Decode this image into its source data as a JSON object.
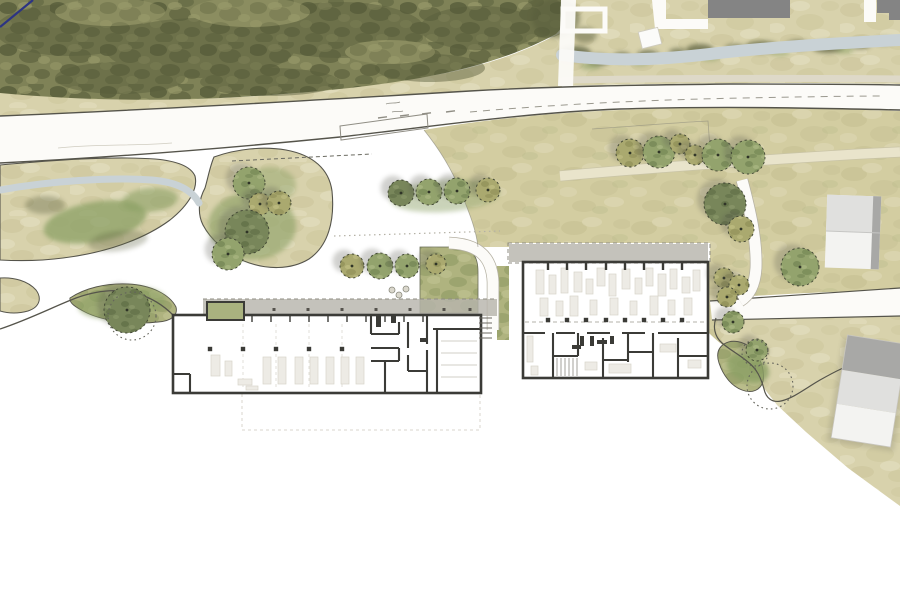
{
  "scene": {
    "width": 900,
    "height": 600,
    "type": "architectural-site-plan"
  },
  "palette": {
    "paper": "#ffffff",
    "forest": "#7f8257",
    "forest_dark": "#585d3b",
    "forest_lite": "#9b9c6c",
    "ground": "#d8d2ac",
    "ground_dark": "#c9c297",
    "ground_lite": "#e5dfc2",
    "lawn": "#d3cda1",
    "lawn_dark": "#c3bd90",
    "lawn_lite": "#e0dab8",
    "lawn_green": "#b7b98a",
    "green": "#afb37f",
    "green_deep": "#8a9660",
    "green_lite": "#c6c797",
    "scrub": "#565b3a",
    "bush": "#8ba065",
    "stream": "#c9d2d6",
    "road_fill": "#fcfbf8",
    "road_line": "#55544b",
    "soft_line": "#b7b3a5",
    "wall": "#3b3b37",
    "furn": "#edebe5",
    "furn_edge": "#d7d4ca",
    "canopy": "#b7b4ac",
    "roof": "#848484",
    "house_lite": "#f3f3f1",
    "house_mid": "#e0e0de",
    "house_side": "#a8a8a6",
    "blue": "#2c3483",
    "shadow": "#57574d",
    "tree_g": "#93a36d",
    "tree_o": "#aaa96f",
    "tree_d": "#78865a",
    "tree_edge": "#3f4433",
    "dot": "#2f3427"
  },
  "trees": {
    "planted": [
      [
        630,
        153,
        14,
        "o"
      ],
      [
        659,
        152,
        16,
        "g"
      ],
      [
        680,
        144,
        10,
        "o"
      ],
      [
        695,
        155,
        10,
        "o"
      ],
      [
        718,
        155,
        16,
        "g"
      ],
      [
        748,
        157,
        17,
        "g"
      ],
      [
        725,
        204,
        21,
        "d"
      ],
      [
        741,
        229,
        13,
        "o"
      ],
      [
        800,
        267,
        19,
        "g"
      ],
      [
        724,
        278,
        10,
        "o"
      ],
      [
        739,
        285,
        10,
        "o"
      ],
      [
        727,
        297,
        10,
        "o"
      ],
      [
        733,
        322,
        11,
        "g"
      ],
      [
        757,
        350,
        11,
        "g"
      ],
      [
        249,
        183,
        16,
        "g"
      ],
      [
        260,
        204,
        11,
        "o"
      ],
      [
        279,
        203,
        12,
        "o"
      ],
      [
        247,
        232,
        22,
        "d"
      ],
      [
        228,
        254,
        16,
        "g"
      ],
      [
        401,
        193,
        13,
        "d"
      ],
      [
        429,
        192,
        13,
        "g"
      ],
      [
        457,
        191,
        13,
        "g"
      ],
      [
        488,
        190,
        12,
        "o"
      ],
      [
        352,
        266,
        12,
        "o"
      ],
      [
        380,
        266,
        13,
        "g"
      ],
      [
        407,
        266,
        12,
        "g"
      ],
      [
        436,
        264,
        10,
        "o"
      ],
      [
        127,
        310,
        23,
        "d"
      ]
    ],
    "dotted": [
      [
        770,
        386,
        23
      ],
      [
        755,
        353,
        13
      ],
      [
        132,
        316,
        24
      ]
    ]
  },
  "vegetation": [
    [
      575,
      53,
      16,
      7,
      0,
      "d",
      0.75
    ],
    [
      598,
      60,
      12,
      6,
      0,
      "d",
      0.7
    ],
    [
      622,
      57,
      9,
      5,
      0,
      "d",
      0.65
    ],
    [
      648,
      55,
      11,
      5,
      0,
      "d",
      0.7
    ],
    [
      678,
      52,
      9,
      4,
      0,
      "d",
      0.6
    ],
    [
      700,
      50,
      14,
      6,
      0,
      "d",
      0.7
    ],
    [
      735,
      48,
      10,
      4,
      0,
      "d",
      0.6
    ],
    [
      762,
      47,
      17,
      6,
      0,
      "d",
      0.72
    ],
    [
      798,
      45,
      12,
      5,
      0,
      "d",
      0.65
    ],
    [
      828,
      47,
      16,
      6,
      0,
      "d",
      0.72
    ],
    [
      860,
      44,
      11,
      5,
      0,
      "d",
      0.65
    ],
    [
      884,
      41,
      9,
      4,
      0,
      "d",
      0.6
    ],
    [
      590,
      66,
      10,
      4,
      0,
      "g",
      0.55
    ],
    [
      640,
      62,
      9,
      4,
      0,
      "g",
      0.5
    ],
    [
      710,
      57,
      10,
      4,
      0,
      "g",
      0.55
    ],
    [
      780,
      52,
      10,
      4,
      0,
      "g",
      0.5
    ],
    [
      845,
      50,
      9,
      4,
      0,
      "g",
      0.5
    ],
    [
      556,
      18,
      24,
      20,
      0,
      "d",
      0.5
    ],
    [
      585,
      35,
      12,
      8,
      0,
      "d",
      0.45
    ],
    [
      95,
      222,
      52,
      20,
      -10,
      "g",
      0.75
    ],
    [
      150,
      200,
      28,
      12,
      -5,
      "g",
      0.6
    ],
    [
      45,
      205,
      20,
      9,
      0,
      "d",
      0.35
    ],
    [
      118,
      241,
      30,
      10,
      -8,
      "d",
      0.3
    ],
    [
      252,
      226,
      44,
      34,
      0,
      "g",
      0.6
    ],
    [
      270,
      185,
      26,
      18,
      0,
      "g",
      0.45
    ],
    [
      122,
      303,
      44,
      16,
      -5,
      "g",
      0.6
    ],
    [
      748,
      368,
      22,
      14,
      20,
      "g",
      0.8
    ],
    [
      760,
      351,
      9,
      5,
      0,
      "d",
      0.4
    ],
    [
      445,
      196,
      55,
      16,
      -4,
      "g",
      0.45
    ]
  ],
  "buildings": {
    "left": {
      "outline": [
        173,
        315,
        308,
        78
      ],
      "walls": [
        [
          427,
          316,
          427,
          344
        ],
        [
          427,
          350,
          427,
          392
        ],
        [
          433,
          329,
          481,
          329
        ],
        [
          437,
          329,
          437,
          392
        ],
        [
          371,
          316,
          371,
          334
        ],
        [
          371,
          334,
          399,
          334
        ],
        [
          399,
          322,
          399,
          334
        ],
        [
          371,
          348,
          399,
          348
        ],
        [
          399,
          348,
          399,
          361
        ],
        [
          371,
          361,
          399,
          361
        ],
        [
          385,
          361,
          385,
          392
        ],
        [
          408,
          322,
          408,
          348
        ],
        [
          408,
          355,
          408,
          371
        ],
        [
          408,
          371,
          426,
          371
        ],
        [
          173,
          374,
          190,
          374
        ],
        [
          190,
          374,
          190,
          392
        ]
      ],
      "stubs": [
        [
          376,
          316,
          5,
          11
        ],
        [
          391,
          316,
          5,
          7
        ],
        [
          420,
          338,
          7,
          4
        ]
      ],
      "columns": {
        "y": 349,
        "xs": [
          210,
          243,
          276,
          309,
          342
        ]
      },
      "facade_ticks": {
        "y": 316,
        "h": 6,
        "xs": [
          252,
          271,
          290,
          309,
          328,
          347,
          366,
          385,
          404,
          423
        ]
      },
      "grid_lines": {
        "y1": 324,
        "y2": 390,
        "xs": [
          243,
          276,
          309,
          342
        ]
      },
      "vehicles": [
        [
          263,
          357,
          8,
          27
        ],
        [
          278,
          357,
          8,
          27
        ],
        [
          295,
          357,
          8,
          27
        ],
        [
          310,
          357,
          8,
          27
        ],
        [
          326,
          357,
          8,
          27
        ],
        [
          341,
          357,
          8,
          27
        ],
        [
          356,
          357,
          8,
          27
        ],
        [
          211,
          355,
          9,
          21
        ],
        [
          225,
          361,
          7,
          15
        ],
        [
          238,
          379,
          14,
          6
        ],
        [
          246,
          386,
          12,
          4
        ]
      ],
      "room_lines": {
        "x1": 441,
        "x2": 477,
        "ys": [
          341,
          353,
          365,
          377
        ]
      },
      "basement": [
        242,
        393,
        238,
        37
      ],
      "canopy": [
        203,
        299,
        294,
        17
      ],
      "canopy_ticks": {
        "y": 308,
        "xs": [
          240,
          274,
          308,
          342,
          376,
          410,
          444,
          470
        ]
      },
      "planter": [
        207,
        302,
        37,
        18
      ]
    },
    "right": {
      "outline": [
        523,
        262,
        185,
        116
      ],
      "walls": [
        [
          523,
          333,
          545,
          333
        ],
        [
          556,
          333,
          575,
          333
        ],
        [
          587,
          333,
          610,
          333
        ],
        [
          622,
          333,
          645,
          333
        ],
        [
          658,
          333,
          708,
          333
        ],
        [
          553,
          333,
          553,
          377
        ],
        [
          578,
          333,
          578,
          356
        ],
        [
          603,
          338,
          603,
          377
        ],
        [
          628,
          333,
          628,
          362
        ],
        [
          653,
          333,
          653,
          377
        ],
        [
          678,
          338,
          678,
          377
        ],
        [
          553,
          356,
          578,
          356
        ],
        [
          603,
          360,
          628,
          360
        ],
        [
          628,
          352,
          653,
          352
        ],
        [
          678,
          356,
          708,
          356
        ]
      ],
      "stubs": [
        [
          580,
          336,
          4,
          10
        ],
        [
          590,
          336,
          4,
          10
        ],
        [
          597,
          340,
          10,
          4
        ],
        [
          572,
          345,
          9,
          4
        ],
        [
          610,
          336,
          4,
          8
        ]
      ],
      "top_bars": {
        "y": 263,
        "h": 7,
        "xs": [
          548,
          567,
          586,
          606,
          625,
          644,
          663,
          682
        ]
      },
      "mid_columns": {
        "y": 320,
        "xs": [
          548,
          567,
          586,
          606,
          625,
          644,
          663,
          682
        ]
      },
      "mid_dash": {
        "y": 322,
        "x1": 525,
        "x2": 706
      },
      "equipment": [
        [
          536,
          270,
          8,
          24
        ],
        [
          549,
          275,
          7,
          19
        ],
        [
          561,
          268,
          7,
          25
        ],
        [
          574,
          272,
          8,
          20
        ],
        [
          586,
          279,
          7,
          15
        ],
        [
          597,
          268,
          8,
          18
        ],
        [
          609,
          274,
          7,
          22
        ],
        [
          622,
          269,
          8,
          20
        ],
        [
          635,
          278,
          7,
          16
        ],
        [
          646,
          268,
          7,
          18
        ],
        [
          658,
          274,
          8,
          22
        ],
        [
          670,
          269,
          7,
          20
        ],
        [
          682,
          277,
          8,
          16
        ],
        [
          693,
          270,
          7,
          21
        ],
        [
          540,
          298,
          8,
          18
        ],
        [
          556,
          301,
          7,
          15
        ],
        [
          570,
          296,
          8,
          20
        ],
        [
          590,
          300,
          7,
          15
        ],
        [
          610,
          298,
          8,
          17
        ],
        [
          630,
          301,
          7,
          14
        ],
        [
          650,
          296,
          8,
          19
        ],
        [
          668,
          300,
          7,
          15
        ],
        [
          684,
          298,
          8,
          17
        ],
        [
          609,
          364,
          22,
          9
        ],
        [
          585,
          362,
          12,
          8
        ],
        [
          660,
          344,
          16,
          8
        ],
        [
          688,
          360,
          13,
          8
        ],
        [
          527,
          336,
          6,
          26
        ],
        [
          531,
          366,
          7,
          9
        ]
      ],
      "stair_hatch": {
        "y1": 358,
        "y2": 376,
        "xs": [
          557,
          561,
          565,
          569,
          573,
          577
        ]
      },
      "canopy": [
        509,
        244,
        199,
        18
      ],
      "canopy_dash": [
        508,
        243,
        202,
        20
      ]
    },
    "stairs_between": {
      "x1": 479,
      "x2": 492,
      "ys": [
        318,
        323,
        328,
        333,
        338
      ]
    },
    "courtyard_circles": {
      "r": 3,
      "pts": [
        [
          392,
          290
        ],
        [
          399,
          295
        ],
        [
          406,
          289
        ]
      ]
    }
  },
  "neighbors": {
    "flat_roof": [
      708,
      0,
      82,
      18
    ],
    "flat_roof_notched": "M877,0 L900,0 L900,20 L889,20 L889,13 L877,13 Z",
    "white_square": {
      "cx": 650,
      "cy": 38,
      "w": 20,
      "h": 17,
      "rot": -14
    },
    "house_north": {
      "cx": 853,
      "cy": 232,
      "w": 54,
      "h": 73,
      "rot": 2
    },
    "house_south": {
      "cx": 869,
      "cy": 391,
      "w": 60,
      "h": 104,
      "rot": 9
    }
  },
  "markings": {
    "bus_bay": "340,126 427,114 428,128 341,140",
    "lane_dashes": [
      [
        378,
        118
      ],
      [
        400,
        116
      ],
      [
        422,
        114
      ],
      [
        446,
        112
      ]
    ],
    "long_dash": "M470,112 C560,104 650,100 740,98 C800,97 845,96 885,96",
    "property_dash": "M232,161 L372,154",
    "paving_dots": "M334,236 L500,231",
    "scribbles": [
      "M386,104 c5,-2 9,0 14,-2",
      "M392,112 c4,-1 8,0 11,-1"
    ]
  }
}
